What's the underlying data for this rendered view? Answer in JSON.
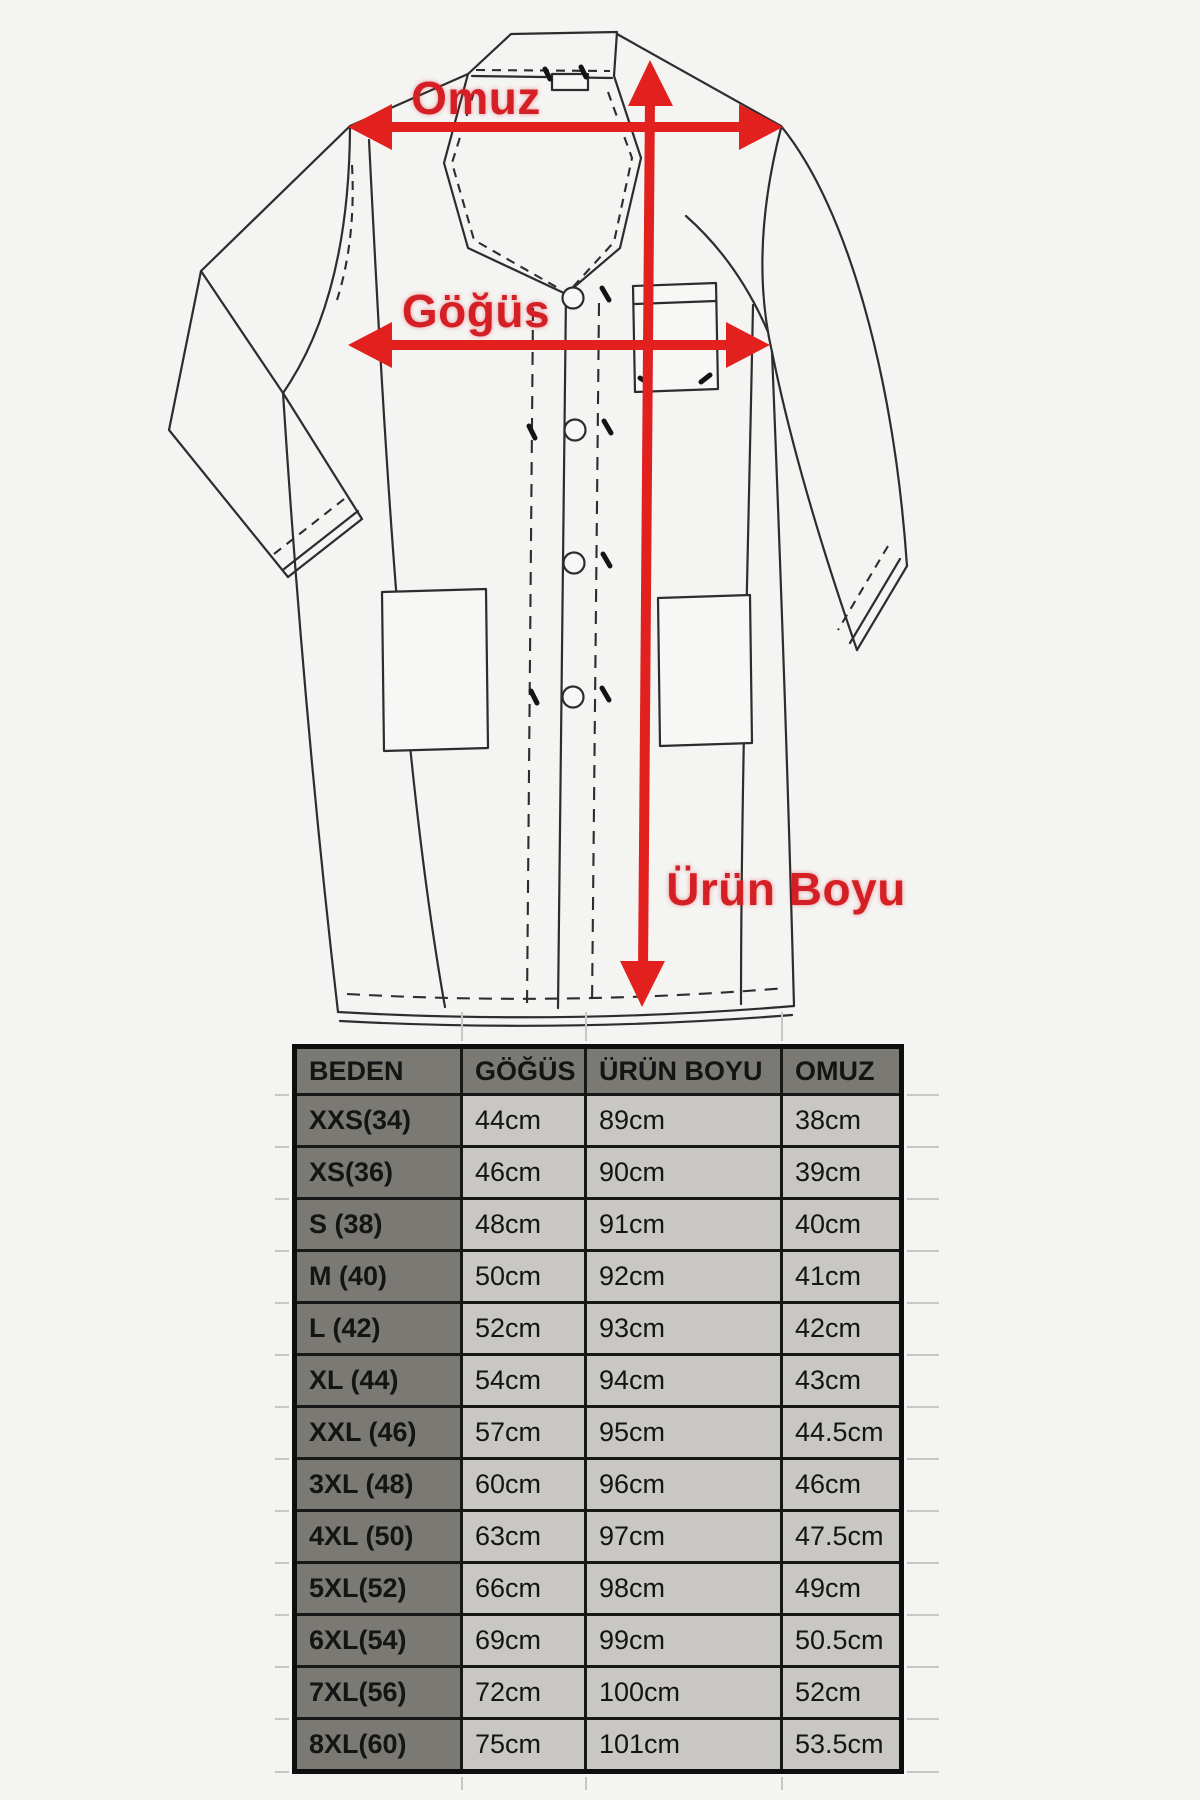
{
  "page": {
    "background": "#f4f4f3"
  },
  "diagram": {
    "type": "labcoat-measurement-diagram",
    "accent_color": "#e2211f",
    "label_color": "#d42025",
    "labels": {
      "shoulder": "Omuz",
      "chest": "Göğüs",
      "length": "Ürün Boyu"
    }
  },
  "size_table": {
    "headers": [
      "BEDEN",
      "GÖĞÜS",
      "ÜRÜN BOYU",
      "OMUZ"
    ],
    "rows": [
      [
        "XXS(34)",
        "44cm",
        "89cm",
        "38cm"
      ],
      [
        "XS(36)",
        "46cm",
        "90cm",
        "39cm"
      ],
      [
        "S (38)",
        "48cm",
        "91cm",
        "40cm"
      ],
      [
        "M (40)",
        "50cm",
        "92cm",
        "41cm"
      ],
      [
        "L (42)",
        "52cm",
        "93cm",
        "42cm"
      ],
      [
        "XL (44)",
        "54cm",
        "94cm",
        "43cm"
      ],
      [
        "XXL (46)",
        "57cm",
        "95cm",
        "44.5cm"
      ],
      [
        "3XL (48)",
        "60cm",
        "96cm",
        "46cm"
      ],
      [
        "4XL (50)",
        "63cm",
        "97cm",
        "47.5cm"
      ],
      [
        "5XL(52)",
        "66cm",
        "98cm",
        "49cm"
      ],
      [
        "6XL(54)",
        "69cm",
        "99cm",
        "50.5cm"
      ],
      [
        "7XL(56)",
        "72cm",
        "100cm",
        "52cm"
      ],
      [
        "8XL(60)",
        "75cm",
        "101cm",
        "53.5cm"
      ]
    ],
    "style": {
      "header_bg": "#7b7974",
      "label_bg": "#7b7974",
      "cell_bg": "#c9c7c4",
      "border_color": "#171717",
      "text_color": "#141414"
    }
  }
}
